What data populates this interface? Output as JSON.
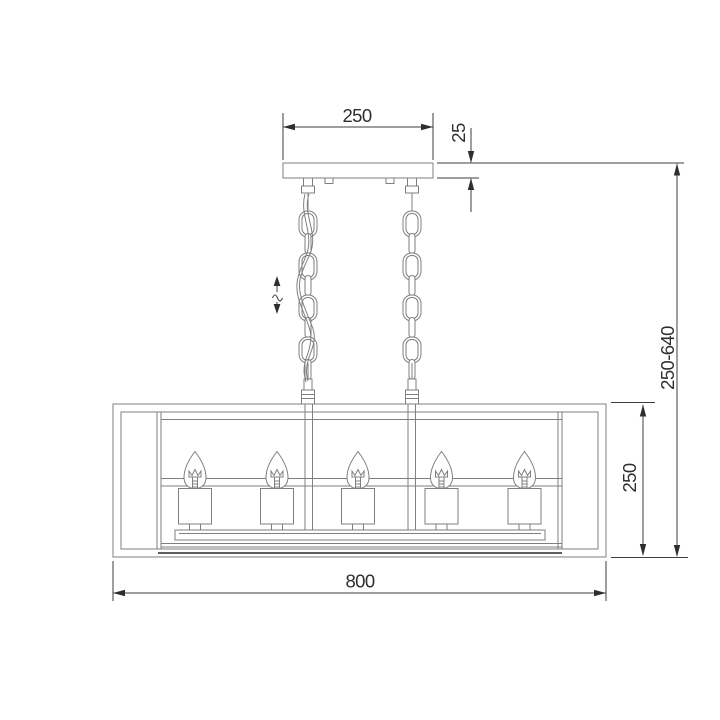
{
  "meta": {
    "drawing_type": "chandelier suspension technical drawing",
    "units_implied": "mm",
    "background_color": "#ffffff",
    "line_color": "#7f7f7f",
    "dimension_color": "#2e2e2e"
  },
  "fixture": {
    "bulb_count": 5,
    "chain_count": 2,
    "height_adjustable": true
  },
  "dimensions": {
    "canopy_width": {
      "value": "250"
    },
    "canopy_thickness": {
      "value": "25"
    },
    "suspension_height_range": {
      "value": "250-640"
    },
    "body_height": {
      "value": "250"
    },
    "body_width": {
      "value": "800"
    }
  }
}
